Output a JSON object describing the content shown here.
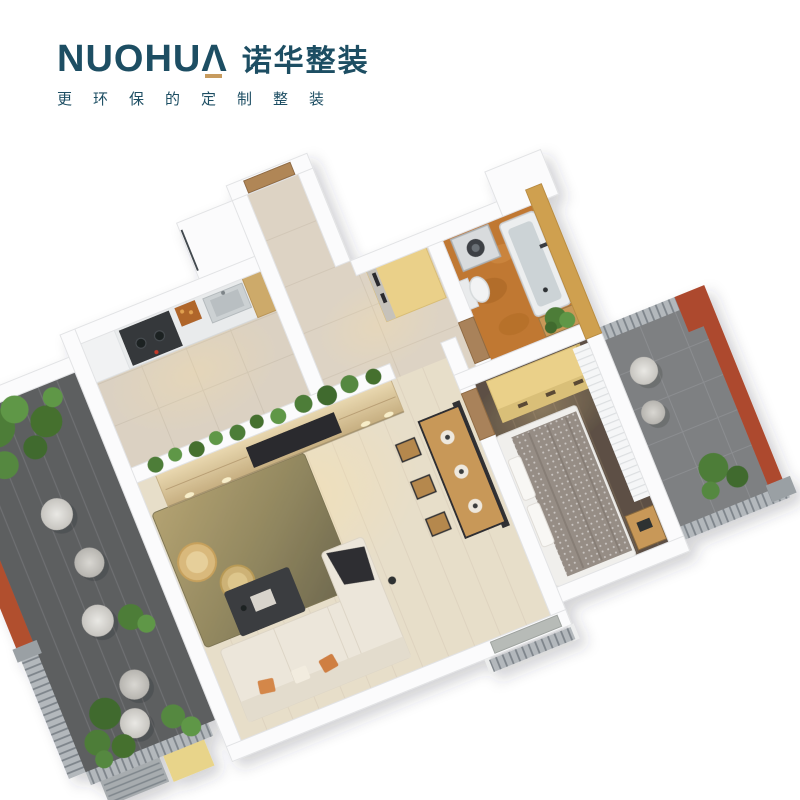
{
  "brand": {
    "name_latin": "NUOHUA",
    "name_latin_display": "NUOHUΛ",
    "name_cn": "诺华整装",
    "tagline": "更环保的定制整装",
    "teal": "#1D4E63",
    "gold": "#C79B5E"
  },
  "scene": {
    "type": "isometric-apartment-floorplan-render",
    "background": "#FFFFFF",
    "rooms": [
      "kitchen",
      "entry-hall",
      "bathroom",
      "living-dining-room",
      "bedroom",
      "left-balcony",
      "right-balcony"
    ],
    "palette": {
      "wall_white": "#FBFBFC",
      "floor_beige": "#DBD1C2",
      "floor_light_wood": "#E7DEC9",
      "floor_dark_wood": "#5D5044",
      "floor_terracotta": "#C07832",
      "tan_wall": "#CFA050",
      "wood_cabinet": "#DCC9A2",
      "yellow_wood": "#EAD089",
      "balcony_plank_gray": "#5D5F61",
      "balcony_stone_gray": "#7E8082",
      "terracotta_wall": "#B14F2E",
      "railing_gray": "#A7ACAF",
      "plant_green": "#4E7D38",
      "sofa_cream": "#ECE6DA",
      "rug_olive": "#8F855E",
      "bed_blanket_gray": "#968D85",
      "table_wood": "#C89858",
      "dark_furniture": "#333538"
    }
  }
}
